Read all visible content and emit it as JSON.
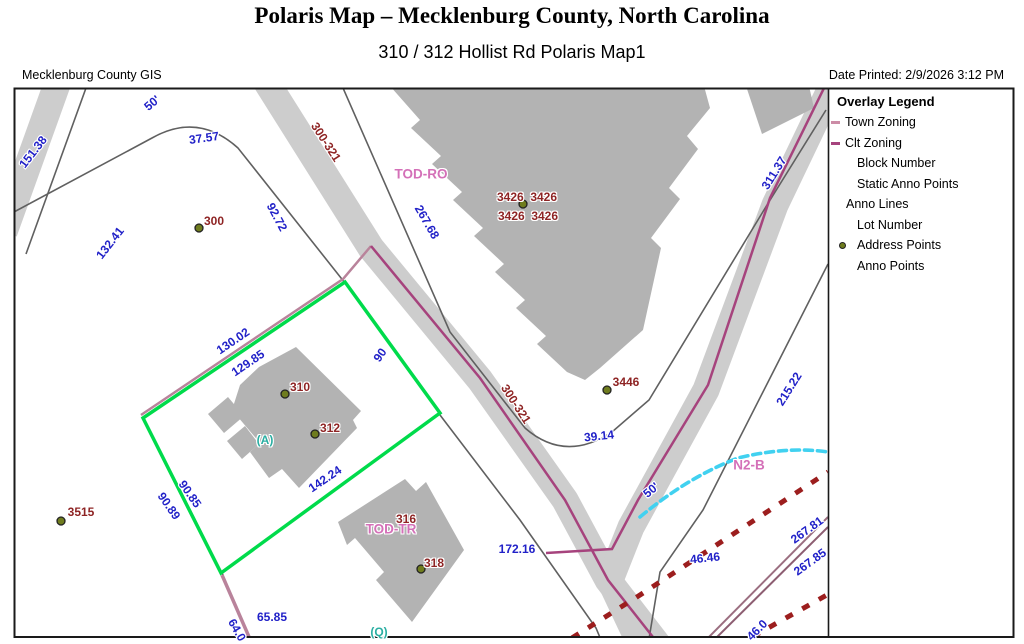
{
  "header": {
    "title": "Polaris Map – Mecklenburg County, North Carolina",
    "subtitle": "310 / 312 Hollist Rd Polaris Map1",
    "source": "Mecklenburg County GIS",
    "date_printed": "Date Printed: 2/9/2026 3:12 PM"
  },
  "legend": {
    "title": "Overlay Legend",
    "items": [
      {
        "label": "Town Zoning",
        "icon": "town-zoning-dash",
        "color": "#cc8ca6"
      },
      {
        "label": "Clt Zoning",
        "icon": "clt-zoning-dash",
        "color": "#a6437d"
      },
      {
        "label": "Block Number",
        "icon": "none"
      },
      {
        "label": "Static Anno Points",
        "icon": "none"
      },
      {
        "label": "Anno Lines",
        "icon": "none"
      },
      {
        "label": "Lot Number",
        "icon": "none"
      },
      {
        "label": "Address Points",
        "icon": "address-point-dot",
        "color": "#6f7c1e"
      },
      {
        "label": "Anno Points",
        "icon": "none"
      }
    ]
  },
  "map": {
    "zones": [
      "TOD-RO",
      "TOD-TR",
      "N2-B"
    ],
    "road_name": "300-321",
    "address_points": [
      "300",
      "310",
      "312",
      "316",
      "318",
      "3426",
      "3446",
      "3515"
    ],
    "lot_letters": [
      "(A)",
      "(Q)"
    ],
    "labels": [
      {
        "t": "151.38"
      },
      {
        "t": "50'"
      },
      {
        "t": "37.57"
      },
      {
        "t": "300-321"
      },
      {
        "t": "92.72"
      },
      {
        "t": "132.41"
      },
      {
        "t": "300"
      },
      {
        "t": "TOD-RO"
      },
      {
        "t": "267.68"
      },
      {
        "t": "3426  3426"
      },
      {
        "t": "3426  3426"
      },
      {
        "t": "311.37"
      },
      {
        "t": "3446"
      },
      {
        "t": "39.14"
      },
      {
        "t": "215.22"
      },
      {
        "t": "90"
      },
      {
        "t": "130.02"
      },
      {
        "t": "129.85"
      },
      {
        "t": "310"
      },
      {
        "t": "312"
      },
      {
        "t": "(A)"
      },
      {
        "t": "142.24"
      },
      {
        "t": "90.85"
      },
      {
        "t": "90.89"
      },
      {
        "t": "3515"
      },
      {
        "t": "TOD-TR"
      },
      {
        "t": "316"
      },
      {
        "t": "318"
      },
      {
        "t": "172.16"
      },
      {
        "t": "65.85"
      },
      {
        "t": "64.0"
      },
      {
        "t": "(Q)"
      },
      {
        "t": "N2-B"
      },
      {
        "t": "50'"
      },
      {
        "t": "46.46"
      },
      {
        "t": "267.81"
      },
      {
        "t": "267.85"
      },
      {
        "t": "46.0"
      },
      {
        "t": "300-321"
      }
    ]
  },
  "colors": {
    "parcel_highlight_green": "#00db4b",
    "road_fill": "#cdcdcd",
    "building_fill": "#b3b3b3",
    "town_zoning": "#cc8ca6",
    "clt_zoning": "#a6437d",
    "red_dashed_boundary": "#9c1e1e",
    "cyan_anno_line": "#41d1f0",
    "dimension_text": "#2121c8",
    "address_text": "#8e2424",
    "zone_text": "#d470b8",
    "address_dot": "#6f7c1e"
  }
}
